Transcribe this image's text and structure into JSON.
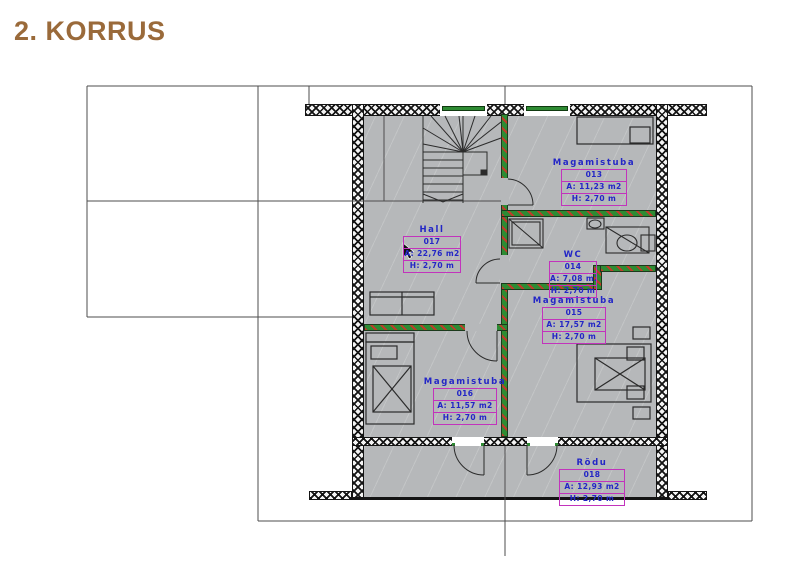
{
  "title": "2. KORRUS",
  "plan": {
    "colors": {
      "title": "#9A6A3A",
      "floor": "#b6b8ba",
      "exterior_wall": "#141414",
      "interior_wall_green": "#2e8b33",
      "interior_wall_red": "#c03a2a",
      "label_text": "#2326c6",
      "label_box_border": "#c233bc"
    },
    "rooms": [
      {
        "id": "hall",
        "name": "Hall",
        "number": "017",
        "area": "A: 22,76 m2",
        "height": "H: 2,70 m"
      },
      {
        "id": "magamistuba-013",
        "name": "Magamistuba",
        "number": "013",
        "area": "A: 11,23 m2",
        "height": "H: 2,70 m"
      },
      {
        "id": "wc-014",
        "name": "WC",
        "number": "014",
        "area": "A: 7,08 m2",
        "height": "H: 2,70 m"
      },
      {
        "id": "magamistuba-015",
        "name": "Magamistuba",
        "number": "015",
        "area": "A: 17,57 m2",
        "height": "H: 2,70 m"
      },
      {
        "id": "magamistuba-016",
        "name": "Magamistuba",
        "number": "016",
        "area": "A: 11,57 m2",
        "height": "H: 2,70 m"
      },
      {
        "id": "rodu-018",
        "name": "Rõdu",
        "number": "018",
        "area": "A: 12,93 m2",
        "height": "H: 2,70 m"
      }
    ]
  }
}
